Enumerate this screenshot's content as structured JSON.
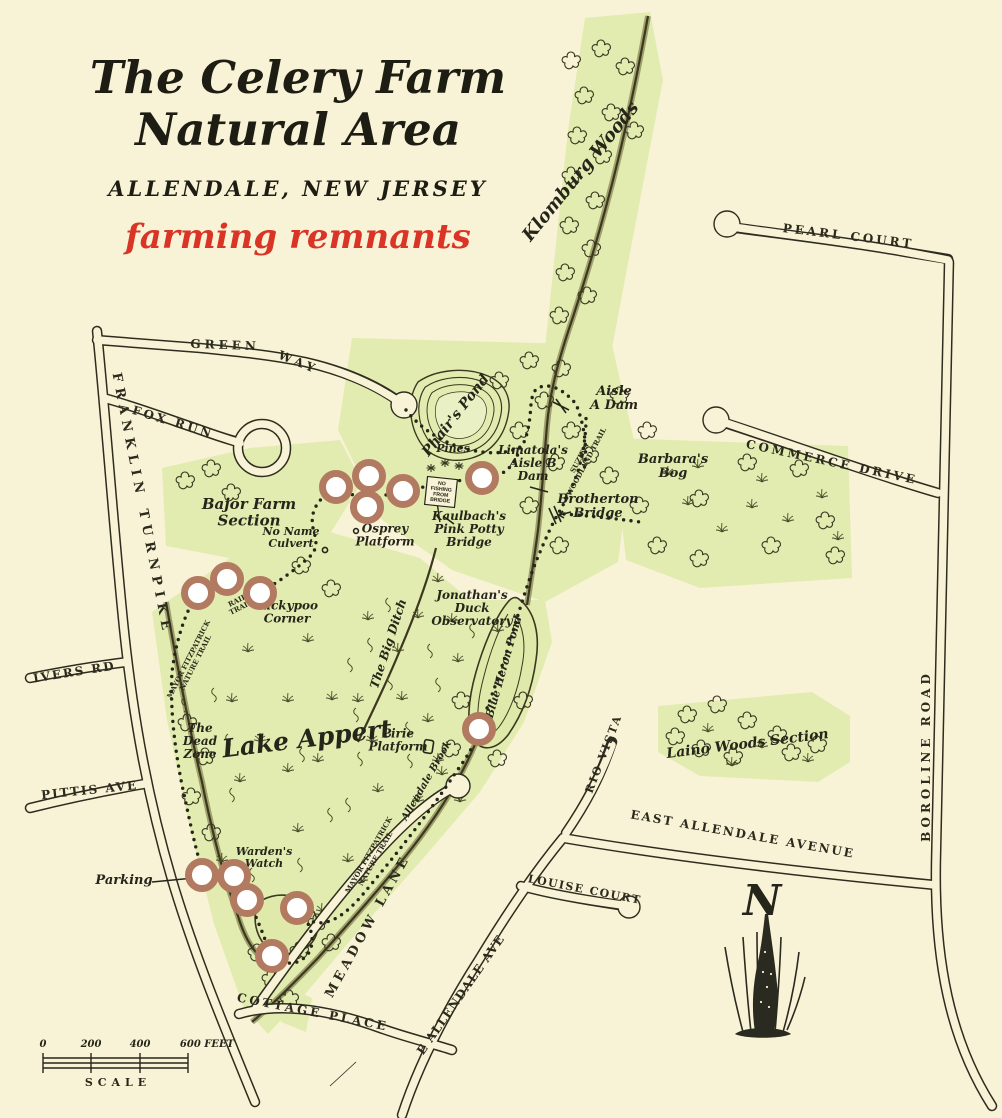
{
  "title": {
    "line1": "The Celery Farm",
    "line2": "Natural Area",
    "subtitle": "ALLENDALE, NEW JERSEY",
    "annotation": "farming remnants"
  },
  "colors": {
    "paper": "#f8f3d6",
    "preserve_green": "#e2ecb0",
    "ink": "#2e2c1e",
    "stream": "#4f482a",
    "annotation_red": "#d93425",
    "marker_ring": "#b27a60",
    "pond_fill": "#e6eebc"
  },
  "compass": {
    "label": "N"
  },
  "scale_bar": {
    "labels": [
      {
        "t": "0",
        "x": 43
      },
      {
        "t": "200",
        "x": 91
      },
      {
        "t": "400",
        "x": 140
      },
      {
        "t": "600 FEET",
        "x": 207
      }
    ],
    "caption": "SCALE"
  },
  "sign": {
    "lines": [
      "NO",
      "FISHING",
      "FROM",
      "BRIDGE"
    ]
  },
  "road_labels": [
    {
      "t": "GREEN",
      "x": 225,
      "y": 349,
      "r": 2,
      "s": 12,
      "ls": 4
    },
    {
      "t": "WAY",
      "x": 297,
      "y": 366,
      "r": 22,
      "s": 12,
      "ls": 4
    },
    {
      "t": "FOX RUN",
      "x": 172,
      "y": 426,
      "r": 17,
      "s": 12,
      "ls": 3
    },
    {
      "t": "FRANKLIN TURNPIKE",
      "x": 138,
      "y": 505,
      "r": 79,
      "s": 13,
      "ls": 6
    },
    {
      "t": "IVERS RD",
      "x": 75,
      "y": 676,
      "r": -9,
      "s": 12,
      "ls": 2
    },
    {
      "t": "PITTIS AVE",
      "x": 90,
      "y": 794,
      "r": -6,
      "s": 12,
      "ls": 2
    },
    {
      "t": "PEARL COURT",
      "x": 848,
      "y": 240,
      "r": 7,
      "s": 12,
      "ls": 3
    },
    {
      "t": "COMMERCE DRIVE",
      "x": 831,
      "y": 466,
      "r": 12,
      "s": 12,
      "ls": 3
    },
    {
      "t": "BOROLINE ROAD",
      "x": 930,
      "y": 756,
      "r": -90,
      "s": 12,
      "ls": 4
    },
    {
      "t": "EAST ALLENDALE AVENUE",
      "x": 742,
      "y": 838,
      "r": 10,
      "s": 12,
      "ls": 2
    },
    {
      "t": "E ALLENDALE AVE",
      "x": 464,
      "y": 997,
      "r": -55,
      "s": 12,
      "ls": 1
    },
    {
      "t": "LOUISE COURT",
      "x": 584,
      "y": 893,
      "r": 11,
      "s": 11,
      "ls": 1.5
    },
    {
      "t": "RIO VISTA",
      "x": 607,
      "y": 755,
      "r": -69,
      "s": 11,
      "ls": 2
    },
    {
      "t": "MEADOW LANE",
      "x": 371,
      "y": 928,
      "r": -61,
      "s": 13,
      "ls": 4
    },
    {
      "t": "COTTAGE PLACE",
      "x": 312,
      "y": 1016,
      "r": 11,
      "s": 12,
      "ls": 3
    }
  ],
  "feature_labels": [
    {
      "t": "Klomburg Woods",
      "x": 585,
      "y": 175,
      "r": -51,
      "s": 18,
      "big": true
    },
    {
      "t": "Phair's Pond",
      "x": 459,
      "y": 418,
      "r": -52,
      "s": 14
    },
    {
      "t": "Aisle\nA Dam",
      "x": 614,
      "y": 402,
      "r": 0,
      "s": 13
    },
    {
      "t": "Limatola's\nAisle B\nDam",
      "x": 533,
      "y": 467,
      "r": 0,
      "s": 12
    },
    {
      "t": "Brotherton\nBridge",
      "x": 598,
      "y": 510,
      "r": 0,
      "s": 13
    },
    {
      "t": "Barbara's\nBog",
      "x": 673,
      "y": 470,
      "r": 0,
      "s": 13
    },
    {
      "t": "Pines",
      "x": 453,
      "y": 452,
      "r": 0,
      "s": 11
    },
    {
      "t": "Kaulbach's\nPink Potty\nBridge",
      "x": 469,
      "y": 533,
      "r": 0,
      "s": 12
    },
    {
      "t": "Osprey\nPlatform",
      "x": 385,
      "y": 539,
      "r": 0,
      "s": 12
    },
    {
      "t": "Bajor Farm\nSection",
      "x": 249,
      "y": 517,
      "r": 0,
      "s": 15
    },
    {
      "t": "No Name\nCulvert",
      "x": 291,
      "y": 541,
      "r": 0,
      "s": 11
    },
    {
      "t": "Kickypoo\nCorner",
      "x": 287,
      "y": 616,
      "r": 0,
      "s": 12
    },
    {
      "t": "The Big Ditch",
      "x": 392,
      "y": 645,
      "r": -72,
      "s": 12
    },
    {
      "t": "Jonathan's\nDuck\nObservatory",
      "x": 472,
      "y": 612,
      "r": 0,
      "s": 12
    },
    {
      "t": "Blue Heron Pond",
      "x": 507,
      "y": 668,
      "r": -74,
      "s": 11
    },
    {
      "t": "Lake Appert",
      "x": 308,
      "y": 747,
      "r": -7,
      "s": 25,
      "big": true
    },
    {
      "t": "The\nDead\nZone",
      "x": 200,
      "y": 745,
      "r": 0,
      "s": 12
    },
    {
      "t": "Pirie\nPlatform",
      "x": 398,
      "y": 744,
      "r": 0,
      "s": 12
    },
    {
      "t": "Allendale Brook",
      "x": 429,
      "y": 782,
      "r": -60,
      "s": 10
    },
    {
      "t": "Laino Woods Section",
      "x": 748,
      "y": 748,
      "r": -7,
      "s": 14,
      "big": true
    },
    {
      "t": "Warden's\nWatch",
      "x": 264,
      "y": 861,
      "r": 0,
      "s": 11
    },
    {
      "t": "Parking",
      "x": 124,
      "y": 884,
      "r": 0,
      "s": 13
    }
  ],
  "trail_labels": [
    {
      "t": "SUZIE'S\nWOODLAND TRAIL",
      "x": 585,
      "y": 461,
      "r": -62,
      "s": 7
    },
    {
      "t": "RAIL\nTRAIL",
      "x": 240,
      "y": 606,
      "r": -27,
      "s": 7
    },
    {
      "t": "MAYOR FITZPATRICK\nNATURE TRAIL",
      "x": 194,
      "y": 662,
      "r": -63,
      "s": 7
    },
    {
      "t": "MAYOR FITZPATRICK\nNATURE TRAIL",
      "x": 374,
      "y": 858,
      "r": -60,
      "s": 7
    }
  ],
  "markers": [
    {
      "x": 336,
      "y": 487
    },
    {
      "x": 369,
      "y": 476
    },
    {
      "x": 367,
      "y": 507
    },
    {
      "x": 403,
      "y": 491
    },
    {
      "x": 482,
      "y": 478
    },
    {
      "x": 198,
      "y": 593
    },
    {
      "x": 227,
      "y": 579
    },
    {
      "x": 260,
      "y": 593
    },
    {
      "x": 479,
      "y": 729
    },
    {
      "x": 202,
      "y": 875
    },
    {
      "x": 234,
      "y": 876
    },
    {
      "x": 247,
      "y": 900
    },
    {
      "x": 297,
      "y": 908
    },
    {
      "x": 272,
      "y": 956
    }
  ]
}
